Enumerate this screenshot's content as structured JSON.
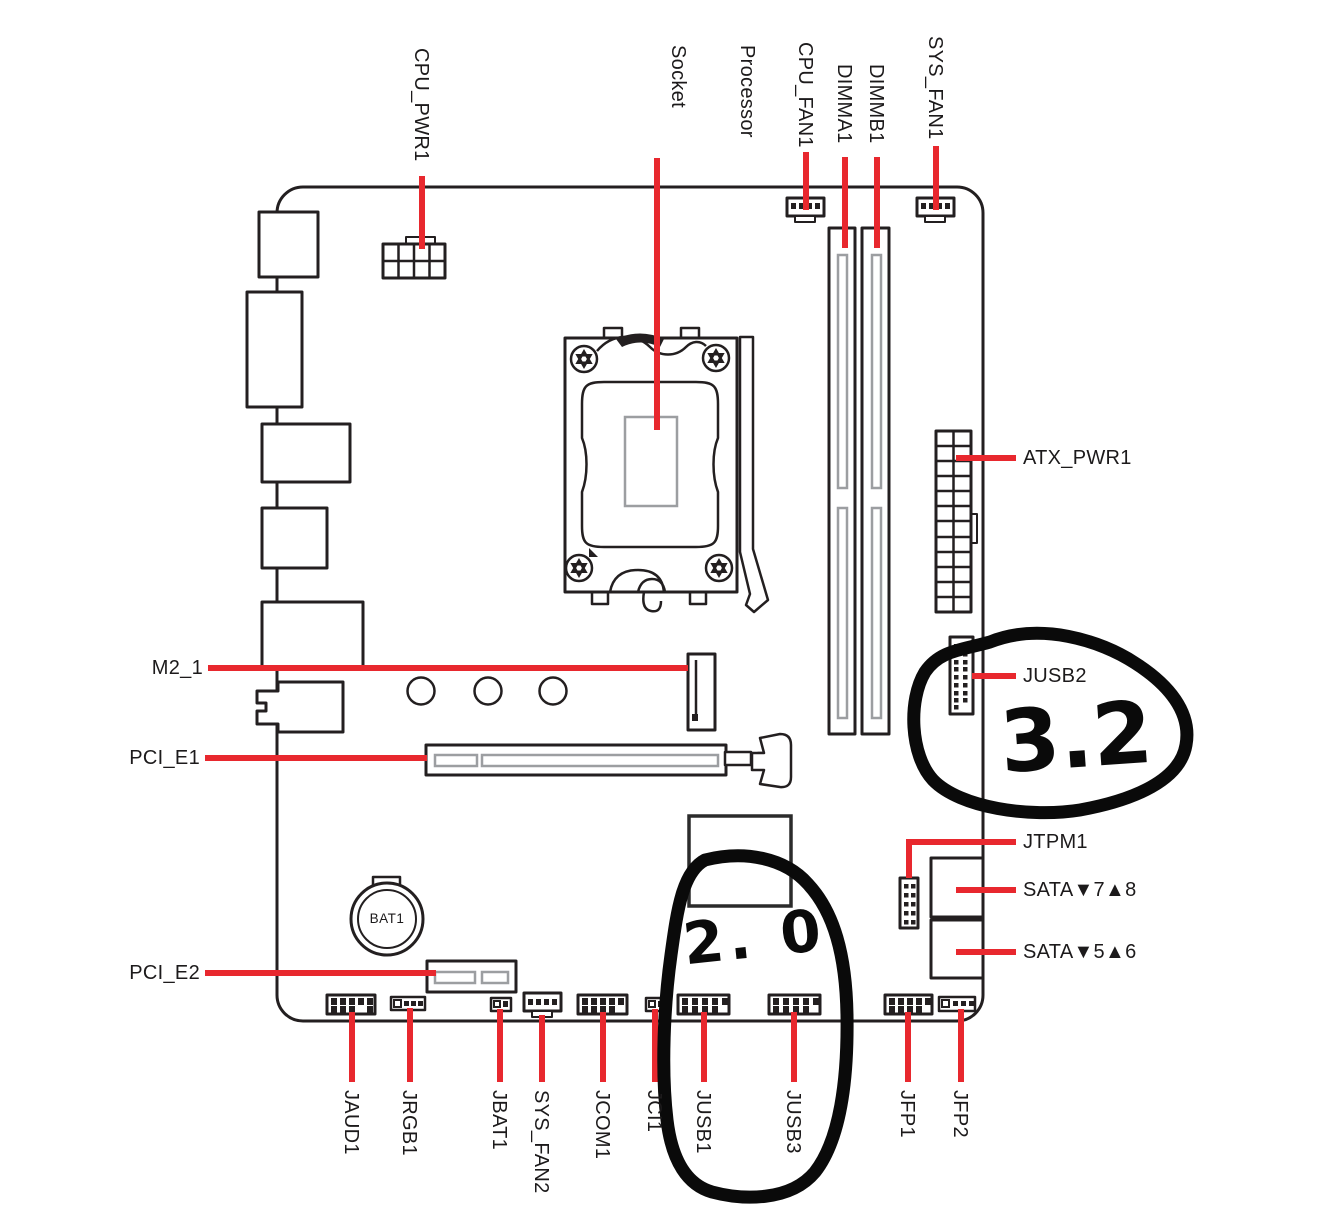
{
  "diagram": {
    "colors": {
      "leader_red": "#e8282e",
      "ink": "#231f20",
      "detail_gray": "#9c9ea1",
      "annotation_ink": "#0a0a0a"
    },
    "labels": {
      "top": [
        {
          "id": "cpu_pwr1",
          "text": "CPU_PWR1"
        },
        {
          "id": "processor_socket",
          "line1": "Processor",
          "line2": "Socket"
        },
        {
          "id": "cpu_fan1",
          "text": "CPU_FAN1"
        },
        {
          "id": "dimma1",
          "text": "DIMMA1"
        },
        {
          "id": "dimmb1",
          "text": "DIMMB1"
        },
        {
          "id": "sys_fan1",
          "text": "SYS_FAN1"
        }
      ],
      "left": [
        {
          "id": "m2_1",
          "text": "M2_1"
        },
        {
          "id": "pci_e1",
          "text": "PCI_E1"
        },
        {
          "id": "pci_e2",
          "text": "PCI_E2"
        }
      ],
      "right": [
        {
          "id": "atx_pwr1",
          "text": "ATX_PWR1"
        },
        {
          "id": "jusb2",
          "text": "JUSB2"
        },
        {
          "id": "jtpm1",
          "text": "JTPM1"
        },
        {
          "id": "sata_7_8",
          "text": "SATA▼7▲8"
        },
        {
          "id": "sata_5_6",
          "text": "SATA▼5▲6"
        }
      ],
      "bottom": [
        {
          "id": "jaud1",
          "text": "JAUD1"
        },
        {
          "id": "jrgb1",
          "text": "JRGB1"
        },
        {
          "id": "jbat1",
          "text": "JBAT1"
        },
        {
          "id": "sys_fan2",
          "text": "SYS_FAN2"
        },
        {
          "id": "jcom1",
          "text": "JCOM1"
        },
        {
          "id": "jci1",
          "text": "JCI1"
        },
        {
          "id": "jusb1",
          "text": "JUSB1"
        },
        {
          "id": "jusb3",
          "text": "JUSB3"
        },
        {
          "id": "jfp1",
          "text": "JFP1"
        },
        {
          "id": "jfp2",
          "text": "JFP2"
        }
      ],
      "battery": "BAT1"
    },
    "annotations": {
      "usb32_note": "3.2",
      "usb20_note": "2. 0"
    }
  }
}
